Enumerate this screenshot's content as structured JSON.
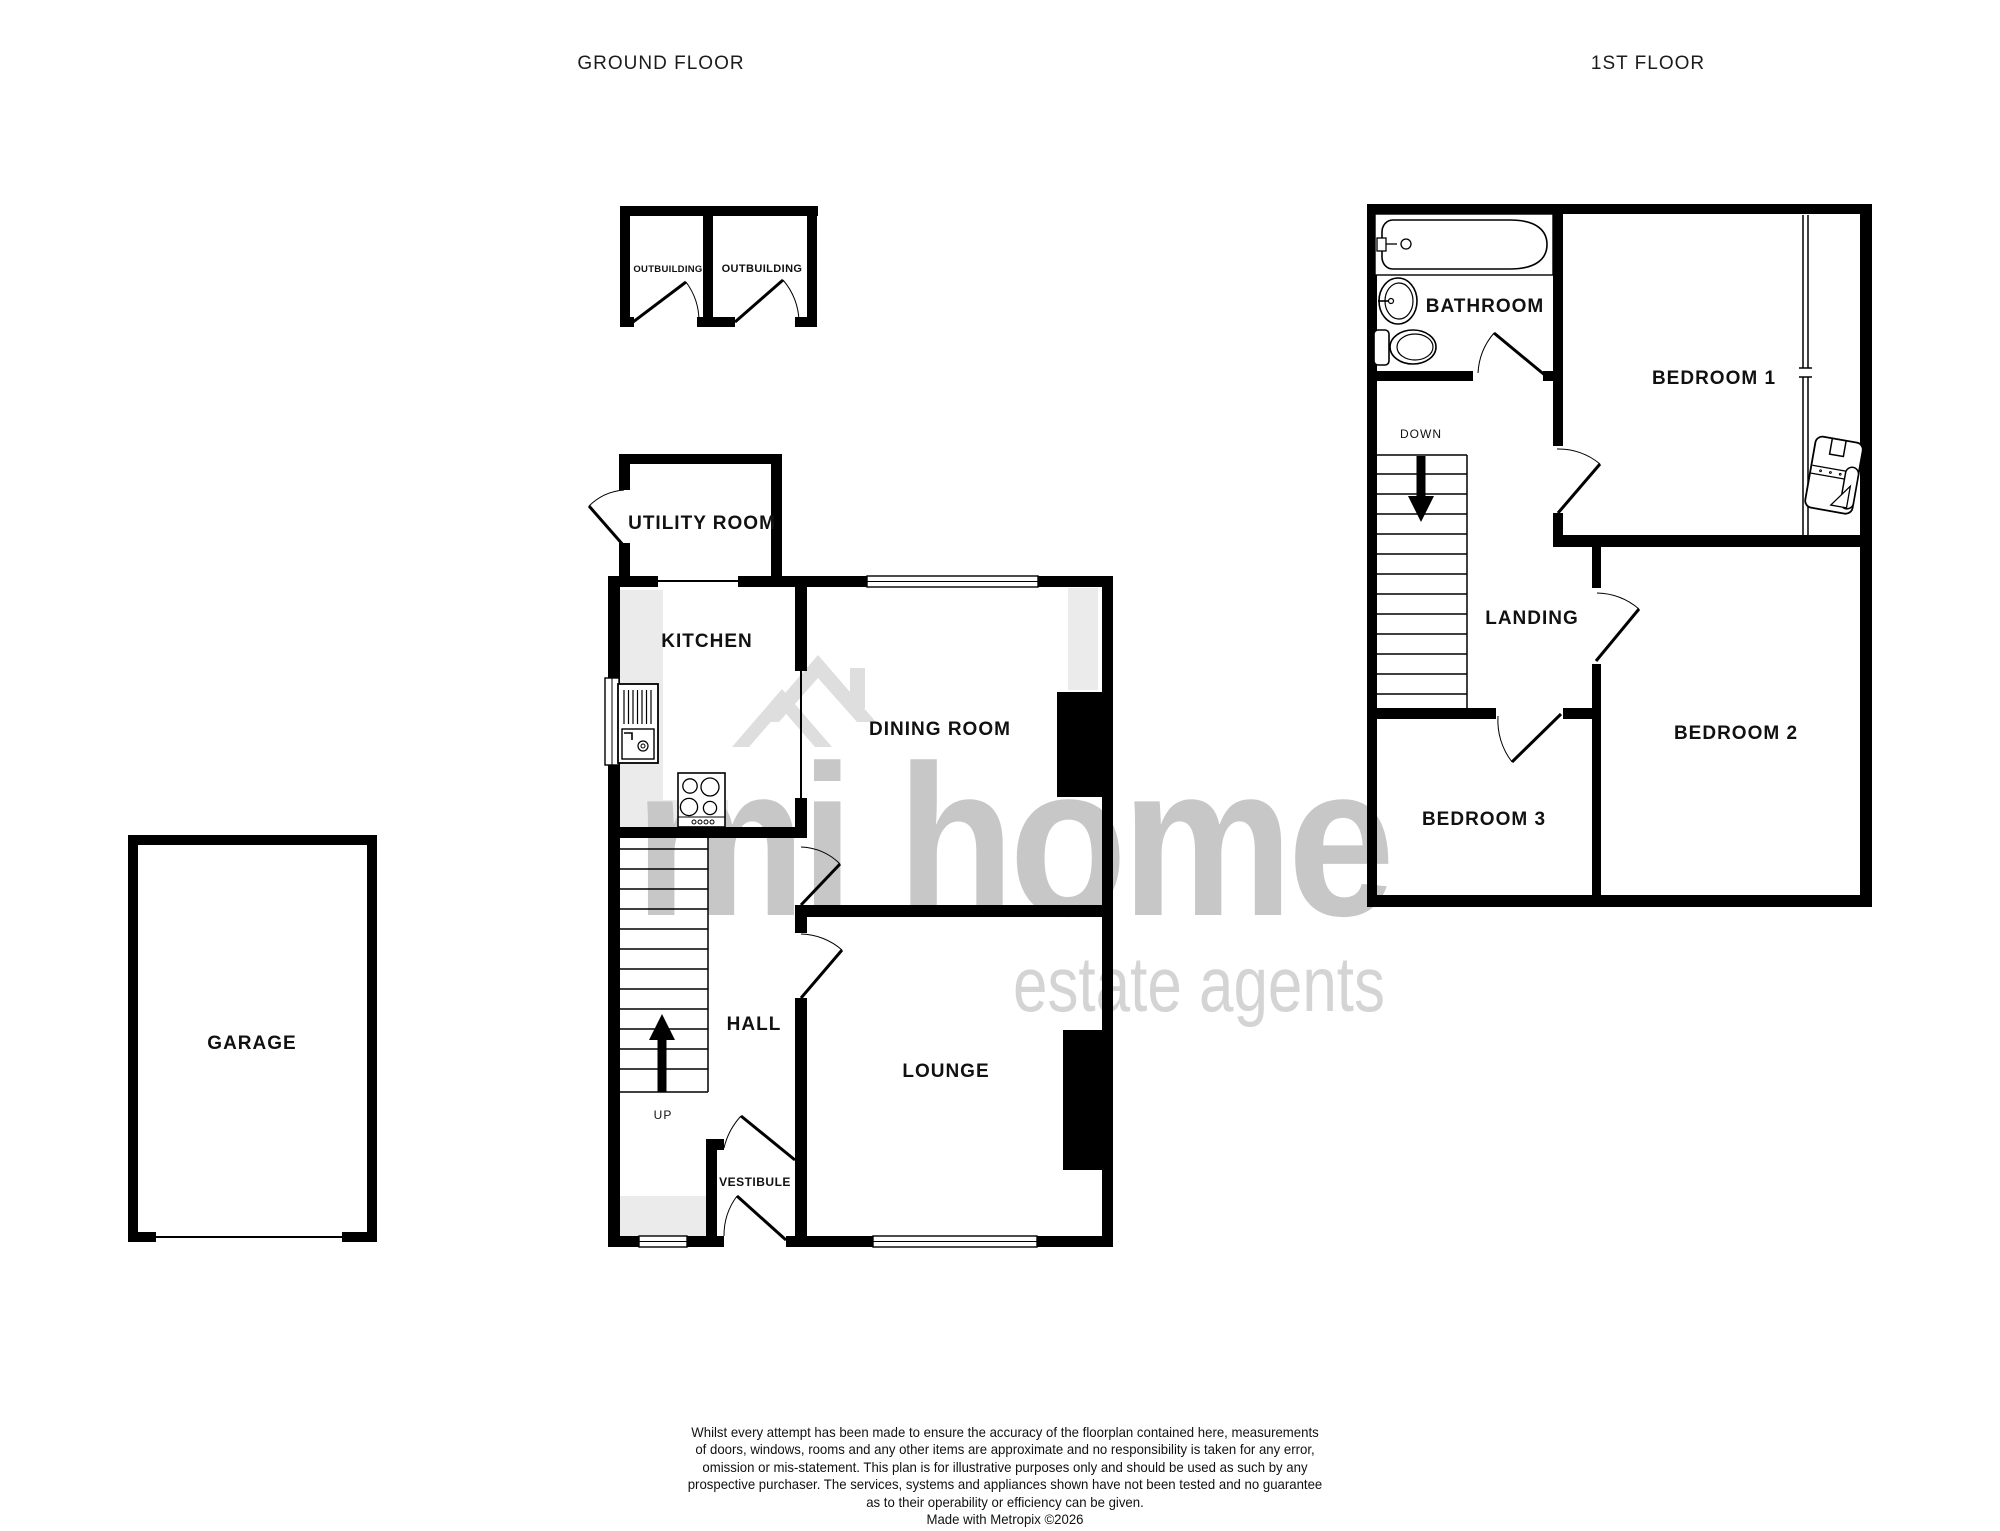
{
  "titles": {
    "ground": "GROUND FLOOR",
    "first": "1ST FLOOR"
  },
  "ground_floor": {
    "outbuilding_left": "OUTBUILDING",
    "outbuilding_right": "OUTBUILDING",
    "utility": "UTILITY ROOM",
    "kitchen": "KITCHEN",
    "dining": "DINING ROOM",
    "hall": "HALL",
    "lounge": "LOUNGE",
    "vestibule": "VESTIBULE",
    "garage": "GARAGE",
    "stairs_up": "UP"
  },
  "first_floor": {
    "bathroom": "BATHROOM",
    "bedroom1": "BEDROOM 1",
    "bedroom2": "BEDROOM 2",
    "bedroom3": "BEDROOM 3",
    "landing": "LANDING",
    "stairs_down": "DOWN"
  },
  "watermark": {
    "brand": "mi home",
    "tagline": "estate agents",
    "brand_color": "#c7c7c7",
    "tagline_color": "#d4d4d4",
    "roof_color": "#dedede"
  },
  "colors": {
    "wall": "#000000",
    "shading": "#ebebeb",
    "text": "#111111"
  },
  "disclaimer": {
    "lines": [
      "Whilst every attempt has been made to ensure the accuracy of the floorplan contained here, measurements",
      "of doors, windows, rooms and any other items are approximate and no responsibility is taken for any error,",
      "omission or mis-statement. This plan is for illustrative purposes only and should be used as such by any",
      "prospective purchaser. The services, systems and appliances shown have not been tested and no guarantee",
      "as to their operability or efficiency can be given."
    ],
    "credit": "Made with Metropix ©2026"
  }
}
